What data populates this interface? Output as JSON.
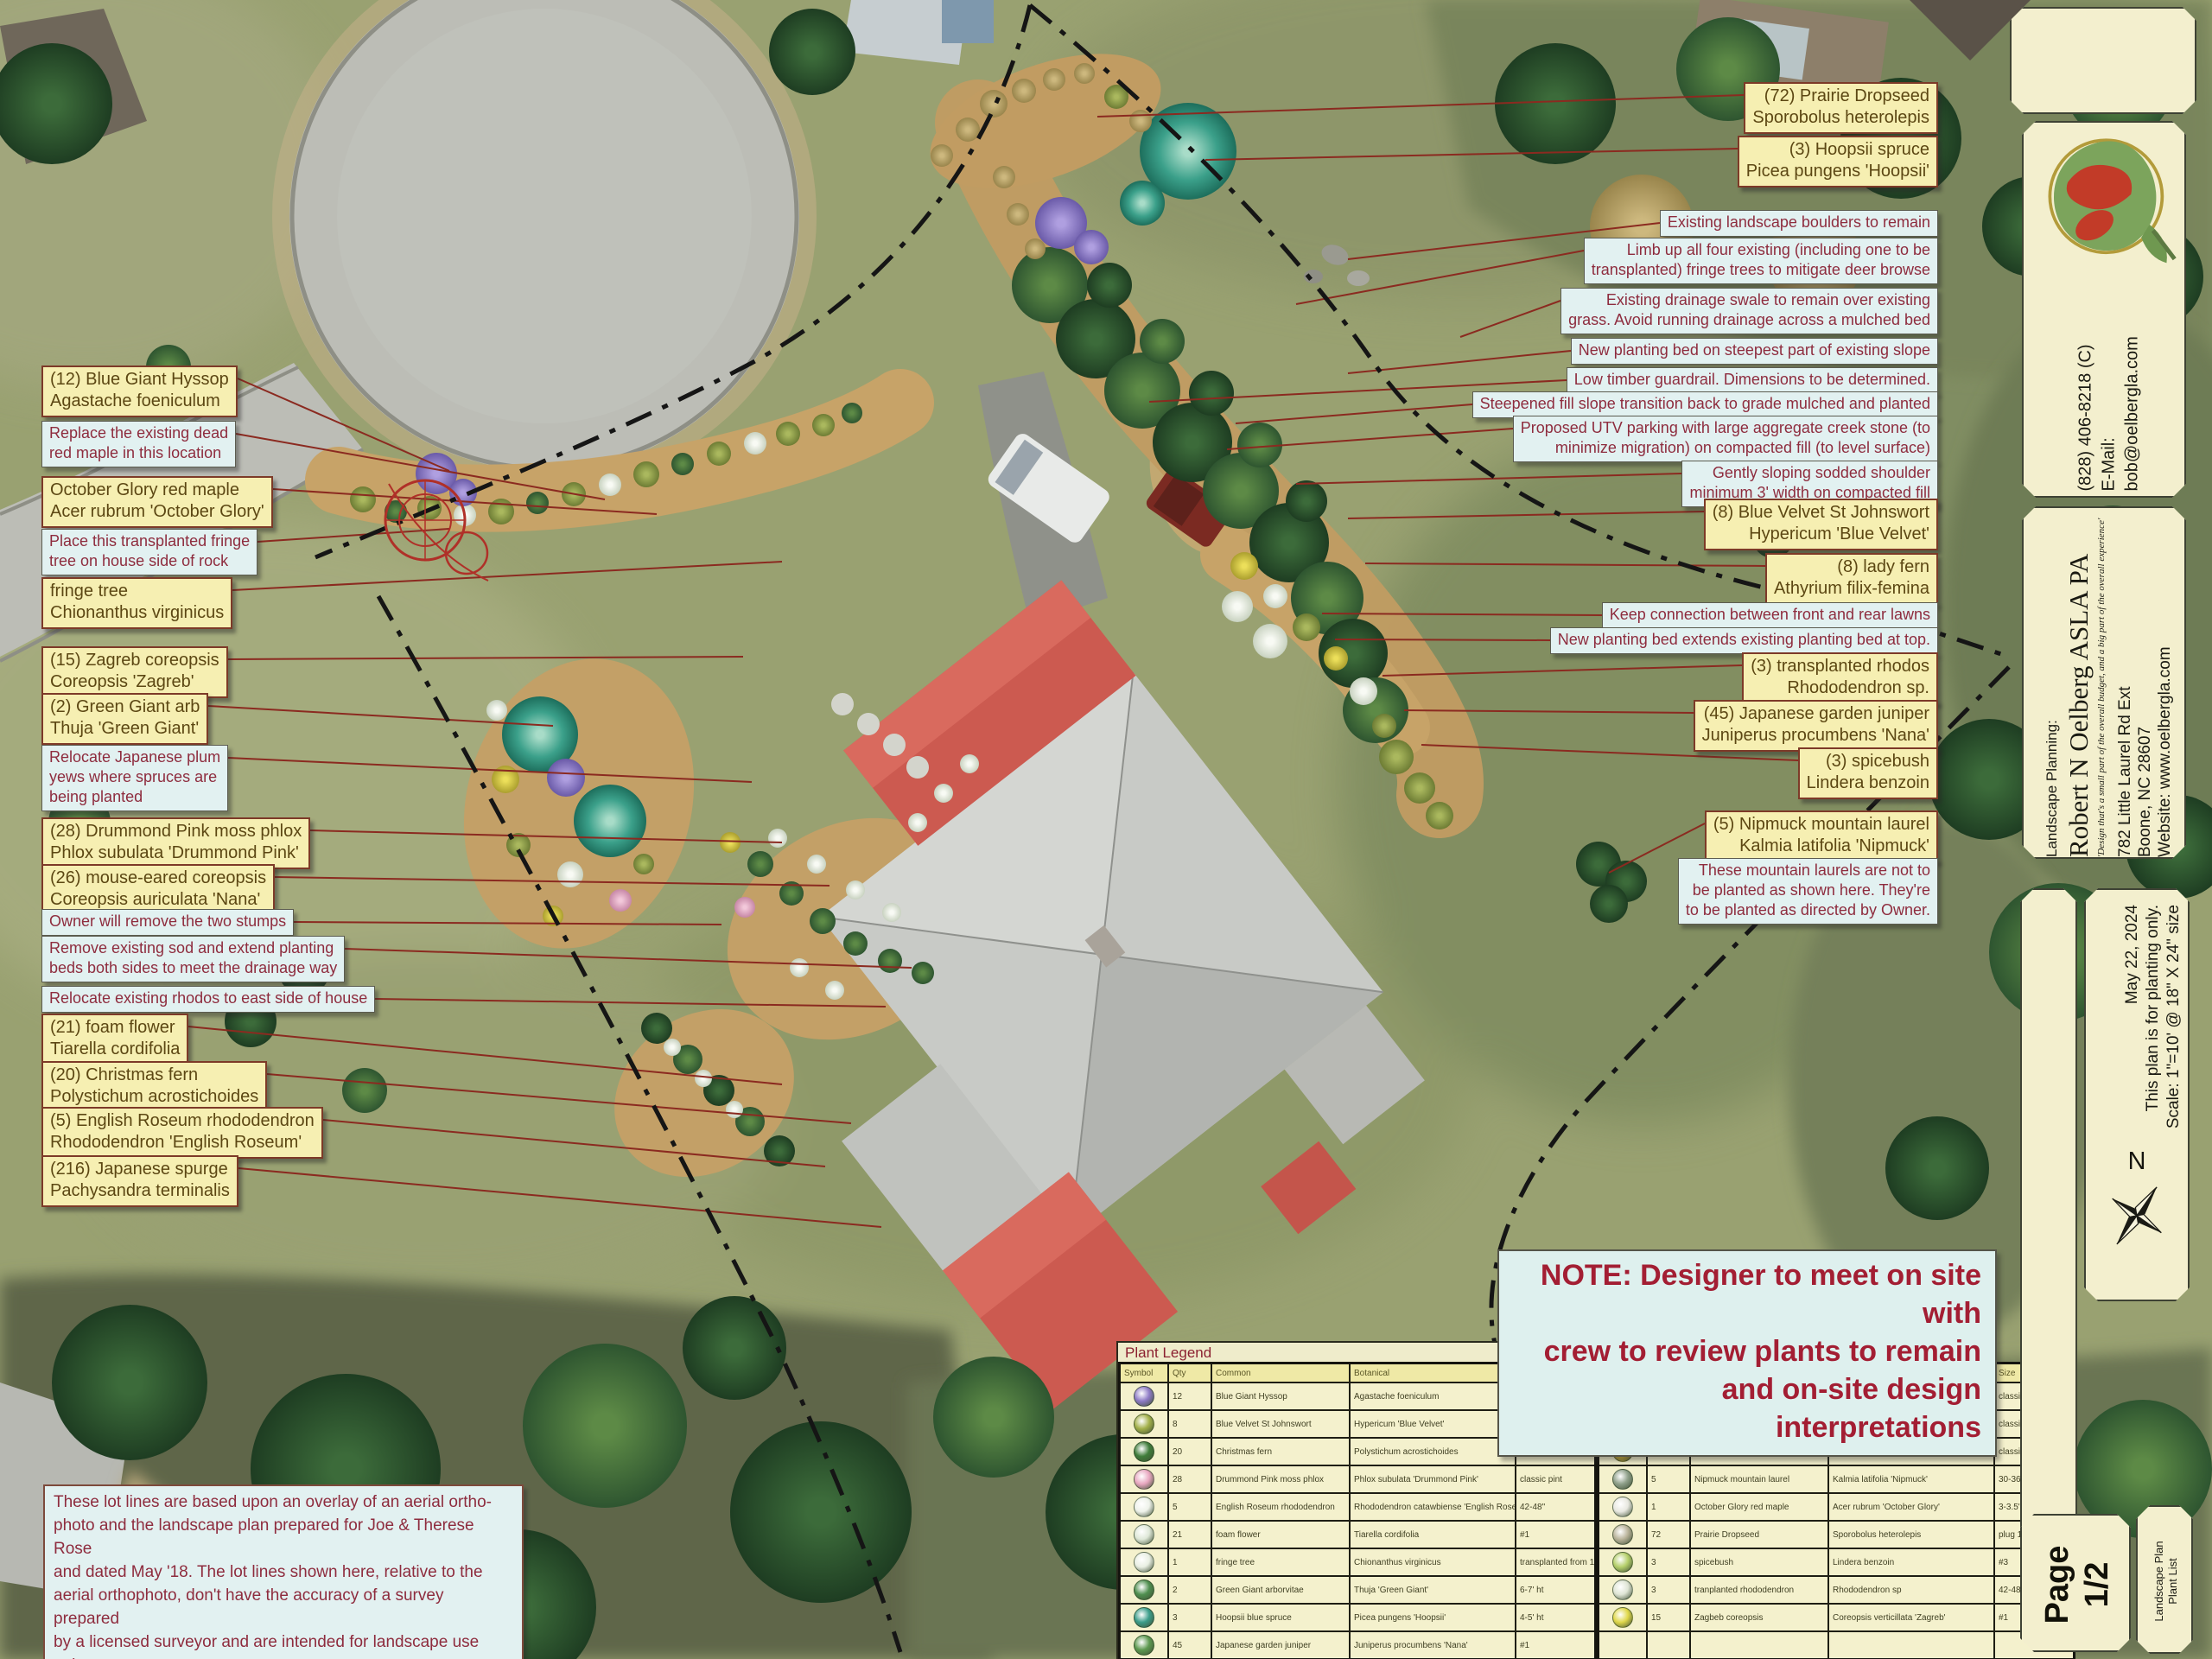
{
  "callouts_left": [
    {
      "kind": "plant",
      "lines": [
        "(12) Blue Giant Hyssop",
        "Agastache foeniculum"
      ]
    },
    {
      "kind": "note",
      "lines": [
        "Replace the existing dead",
        "red maple in this location"
      ]
    },
    {
      "kind": "plant",
      "lines": [
        "October Glory red maple",
        "Acer rubrum 'October Glory'"
      ]
    },
    {
      "kind": "note",
      "lines": [
        "Place this transplanted fringe",
        "tree on house side of rock"
      ]
    },
    {
      "kind": "plant",
      "lines": [
        "fringe tree",
        "Chionanthus virginicus"
      ]
    },
    {
      "kind": "plant",
      "lines": [
        "(15) Zagreb coreopsis",
        "Coreopsis 'Zagreb'"
      ]
    },
    {
      "kind": "plant",
      "lines": [
        "(2) Green Giant arb",
        "Thuja 'Green Giant'"
      ]
    },
    {
      "kind": "note",
      "lines": [
        "Relocate Japanese plum",
        "yews where spruces are",
        "being planted"
      ]
    },
    {
      "kind": "plant",
      "lines": [
        "(28) Drummond Pink moss phlox",
        "Phlox subulata 'Drummond Pink'"
      ]
    },
    {
      "kind": "plant",
      "lines": [
        "(26) mouse-eared coreopsis",
        "Coreopsis auriculata 'Nana'"
      ]
    },
    {
      "kind": "note",
      "lines": [
        "Owner will remove the two stumps"
      ]
    },
    {
      "kind": "note",
      "lines": [
        "Remove existing sod and extend planting",
        "beds both sides to meet the drainage way"
      ]
    },
    {
      "kind": "note",
      "lines": [
        "Relocate existing rhodos to east side of house"
      ]
    },
    {
      "kind": "plant",
      "lines": [
        "(21) foam flower",
        "Tiarella cordifolia"
      ]
    },
    {
      "kind": "plant",
      "lines": [
        "(20) Christmas fern",
        "Polystichum acrostichoides"
      ]
    },
    {
      "kind": "plant",
      "lines": [
        "(5) English Roseum rhododendron",
        "Rhododendron 'English Roseum'"
      ]
    },
    {
      "kind": "plant",
      "lines": [
        "(216) Japanese spurge",
        "Pachysandra terminalis"
      ]
    }
  ],
  "callouts_topright": [
    {
      "kind": "plant",
      "lines": [
        "(72) Prairie Dropseed",
        "Sporobolus heterolepis"
      ]
    },
    {
      "kind": "plant",
      "lines": [
        "(3) Hoopsii spruce",
        "Picea pungens 'Hoopsii'"
      ]
    }
  ],
  "callouts_right": [
    {
      "kind": "note",
      "lines": [
        "Existing landscape boulders to remain"
      ]
    },
    {
      "kind": "note",
      "lines": [
        "Limb up all four existing (including one to be",
        "transplanted) fringe trees to mitigate deer browse"
      ]
    },
    {
      "kind": "note",
      "lines": [
        "Existing drainage swale to remain over existing",
        "grass. Avoid running drainage across a mulched bed"
      ]
    },
    {
      "kind": "note",
      "lines": [
        "New planting bed on steepest part of existing slope"
      ]
    },
    {
      "kind": "note",
      "lines": [
        "Low timber guardrail. Dimensions to be determined."
      ]
    },
    {
      "kind": "note",
      "lines": [
        "Steepened fill slope transition back to grade mulched and planted"
      ]
    },
    {
      "kind": "note",
      "lines": [
        "Proposed UTV parking with large aggregate creek stone (to",
        "minimize migration) on compacted fill (to level surface)"
      ]
    },
    {
      "kind": "note",
      "lines": [
        "Gently sloping sodded shoulder",
        "minimum 3' width on compacted fill"
      ]
    },
    {
      "kind": "plant",
      "lines": [
        "(8) Blue Velvet St Johnswort",
        "Hypericum 'Blue Velvet'"
      ]
    },
    {
      "kind": "plant",
      "lines": [
        "(8) lady fern",
        "Athyrium filix-femina"
      ]
    },
    {
      "kind": "note",
      "lines": [
        "Keep connection between front and rear lawns"
      ]
    },
    {
      "kind": "note",
      "lines": [
        "New planting bed extends existing planting bed at top."
      ]
    },
    {
      "kind": "plant",
      "lines": [
        "(3) transplanted rhodos",
        "Rhododendron sp."
      ]
    },
    {
      "kind": "plant",
      "lines": [
        "(45) Japanese garden juniper",
        "Juniperus procumbens 'Nana'"
      ]
    },
    {
      "kind": "plant",
      "lines": [
        "(3) spicebush",
        "Lindera benzoin"
      ]
    },
    {
      "kind": "plant",
      "lines": [
        "(5) Nipmuck mountain laurel",
        "Kalmia latifolia 'Nipmuck'"
      ]
    },
    {
      "kind": "note",
      "lines": [
        "These mountain laurels are not to",
        "be planted as shown here. They're",
        "to be planted as directed by Owner."
      ]
    }
  ],
  "note_box": {
    "lines": [
      "NOTE: Designer to meet on site with",
      "crew to review plants to remain",
      "and on-site design interpretations"
    ]
  },
  "lot_note": {
    "lines": [
      "These lot lines are based upon an overlay of an aerial ortho-",
      "photo and the landscape plan prepared for Joe & Therese Rose",
      "and dated May '18. The lot lines shown here, relative to the",
      "aerial orthophoto, don't have the accuracy of a survey prepared",
      "by a licensed surveyor and are intended for landscape use only."
    ]
  },
  "legend": {
    "title": "Plant Legend",
    "headers": [
      "Symbol",
      "Qty",
      "Common",
      "Botanical",
      "Size"
    ],
    "left_rows": [
      {
        "qty": "12",
        "common": "Blue Giant Hyssop",
        "botanical": "Agastache foeniculum",
        "size": "#1",
        "symbol_color": "#8e7bc6"
      },
      {
        "qty": "8",
        "common": "Blue Velvet St Johnswort",
        "botanical": "Hypericum 'Blue Velvet'",
        "size": "#3",
        "symbol_color": "#a3b04a"
      },
      {
        "qty": "20",
        "common": "Christmas fern",
        "botanical": "Polystichum acrostichoides",
        "size": "classic pint",
        "symbol_color": "#3f7d3a"
      },
      {
        "qty": "28",
        "common": "Drummond Pink moss phlox",
        "botanical": "Phlox subulata 'Drummond Pink'",
        "size": "classic pint",
        "symbol_color": "#e8a7c0"
      },
      {
        "qty": "5",
        "common": "English Roseum rhododendron",
        "botanical": "Rhododendron catawbiense 'English Roseum'",
        "size": "42-48\"",
        "symbol_color": "#eef2ea"
      },
      {
        "qty": "21",
        "common": "foam flower",
        "botanical": "Tiarella cordifolia",
        "size": "#1",
        "symbol_color": "#dfe8d8"
      },
      {
        "qty": "1",
        "common": "fringe tree",
        "botanical": "Chionanthus virginicus",
        "size": "transplanted from 10' away",
        "symbol_color": "#e9efe3"
      },
      {
        "qty": "2",
        "common": "Green Giant arborvitae",
        "botanical": "Thuja 'Green Giant'",
        "size": "6-7' ht",
        "symbol_color": "#4f8f4f"
      },
      {
        "qty": "3",
        "common": "Hoopsii blue spruce",
        "botanical": "Picea pungens 'Hoopsii'",
        "size": "4-5' ht",
        "symbol_color": "#3b9d8a"
      },
      {
        "qty": "45",
        "common": "Japanese garden juniper",
        "botanical": "Juniperus procumbens 'Nana'",
        "size": "#1",
        "symbol_color": "#5d9950"
      }
    ],
    "right_rows": [
      {
        "qty": "216",
        "common": "Japanese spurge",
        "botanical": "Pachysandra terminalis",
        "size": "classic pint",
        "symbol_color": "#7cab62"
      },
      {
        "qty": "8",
        "common": "lady fern",
        "botanical": "Athyrium filix-femina",
        "size": "classic pint",
        "symbol_color": "#9ccb7a"
      },
      {
        "qty": "26",
        "common": "mouse-eared coreopsis",
        "botanical": "Coreopsis auriculata 'Nana'",
        "size": "classic pint",
        "symbol_color": "#d8b83a"
      },
      {
        "qty": "5",
        "common": "Nipmuck mountain laurel",
        "botanical": "Kalmia latifolia 'Nipmuck'",
        "size": "30-36\" b&b",
        "symbol_color": "#8fa08a"
      },
      {
        "qty": "1",
        "common": "October Glory red maple",
        "botanical": "Acer rubrum 'October Glory'",
        "size": "3-3.5\" cal",
        "symbol_color": "#e8e8e0"
      },
      {
        "qty": "72",
        "common": "Prairie Dropseed",
        "botanical": "Sporobolus heterolepis",
        "size": "plug 18",
        "symbol_color": "#b9b39a"
      },
      {
        "qty": "3",
        "common": "spicebush",
        "botanical": "Lindera benzoin",
        "size": "#3",
        "symbol_color": "#b5cf6b"
      },
      {
        "qty": "3",
        "common": "tranplanted rhododendron",
        "botanical": "Rhododendron sp",
        "size": "42-48\"",
        "symbol_color": "#dfe5d5"
      },
      {
        "qty": "15",
        "common": "Zagbeb coreopsis",
        "botanical": "Coreopsis verticillata 'Zagreb'",
        "size": "#1",
        "symbol_color": "#e0d84a"
      },
      {
        "qty": "",
        "common": "",
        "botanical": "",
        "size": "",
        "symbol_color": ""
      }
    ]
  },
  "sidebar": {
    "phone": "(828) 406-8218 (C)",
    "email": "E-Mail: bob@oelbergla.com",
    "planning_label": "Landscape Planning:",
    "name": "Robert N Oelberg ASLA PA",
    "tagline": "'Design that's a small part of the overall budget, and a big part of the overall experience'",
    "address1": "782 Little Laurel Rd Ext",
    "address2": "Boone, NC 28607",
    "address3": "Website: www.oelbergla.com",
    "plan_title": "Landscape Plan",
    "date": "May 22, 2024",
    "plan_note": "This plan is for planting only.",
    "scale": "Scale: 1\"=10' @ 18\" X 24\" size",
    "north_label": "N",
    "page_label": "Page",
    "page_number": "1/2",
    "list_label_line1": "Landscape Plan",
    "list_label_line2": "Plant List"
  },
  "colors": {
    "plant_box_bg": "#f6efb2",
    "plant_box_text": "#5c4713",
    "note_box_bg": "#e2f1f1",
    "note_box_text": "#8e2c3e",
    "leader_line": "#8b2a20",
    "panel_bg": "#f3efce",
    "note_title_text": "#a31e33",
    "roof_red": "#cc5a50",
    "roof_gray": "#c8cac6"
  }
}
